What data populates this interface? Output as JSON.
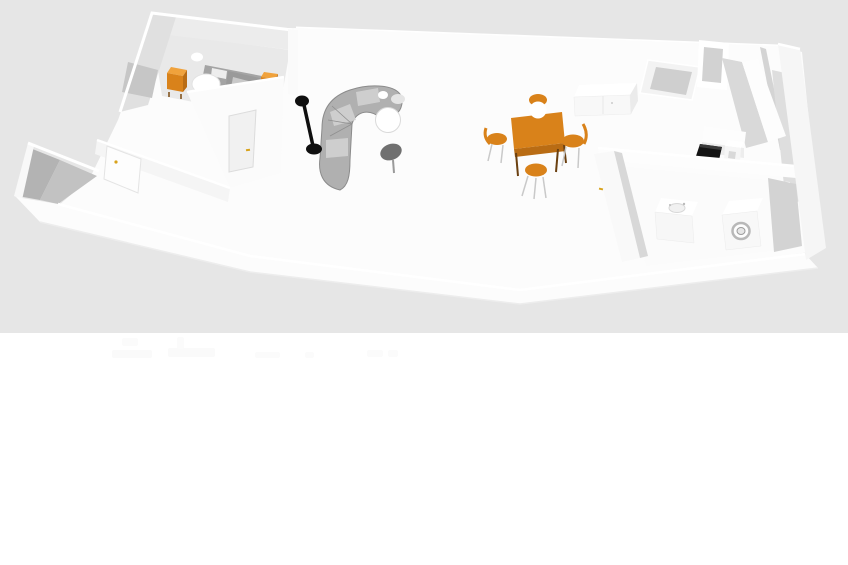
{
  "app": {
    "name": "floor-plan-3d-viewport",
    "description": "Aerial 3D rendering of a one-storey apartment floor plan shown in a design-software viewport. No text, menus or labels are visible - only the rendered model on a light grey viewport above a white page area."
  },
  "canvas": {
    "width": 848,
    "height": 565,
    "viewport_band_height": 333
  },
  "colors": {
    "viewport_bg": "#e6e6e6",
    "page_bg": "#ffffff",
    "wall_white": "#fbfbfb",
    "wall_light": "#f1f1f1",
    "wall_shade": "#d6d6d6",
    "wall_dark": "#b7b7b7",
    "floor": "#fcfcfc",
    "bath_floor": "#e9e9e9",
    "shower_dark": "#a4a4a4",
    "glass": "#ababab",
    "glass_light": "#c4c4c4",
    "orange": "#d9821a",
    "orange_dark": "#b96c14",
    "orange_light": "#f0a23c",
    "sofa_body": "#b0b0b0",
    "sofa_edge": "#8b8b8b",
    "sofa_cushion": "#d2d2d2",
    "lamp_black": "#0f0f0f",
    "cooktop_black": "#141414",
    "side_table_gray": "#707070",
    "handle_yellow": "#d8a21b",
    "ghost": "#fafafa"
  },
  "scene": {
    "rooms": [
      {
        "id": "entry-hall",
        "position": "far left",
        "contents": [
          "entry door with yellow handle"
        ]
      },
      {
        "id": "bathroom-1",
        "position": "top left",
        "contents": [
          "toilet",
          "two orange cabinets",
          "grey shower partition",
          "ceiling lamp",
          "door with yellow handle"
        ]
      },
      {
        "id": "living-room",
        "position": "centre left",
        "contents": [
          "black floor lamp",
          "curved grey sectional sofa",
          "round white ottoman",
          "dark kidney side table",
          "large two-pane window"
        ]
      },
      {
        "id": "dining-area",
        "position": "centre",
        "contents": [
          "orange dining table",
          "four orange chairs",
          "white pendant lamp",
          "lattice wall panel",
          "white sideboard"
        ]
      },
      {
        "id": "kitchen",
        "position": "top right",
        "contents": [
          "L-shaped white counter",
          "black cooktop",
          "open tilted door",
          "door frame"
        ]
      },
      {
        "id": "bathroom-2",
        "position": "bottom right",
        "contents": [
          "washbasin cabinet",
          "washing machine with round door",
          "door with yellow handle"
        ]
      }
    ],
    "object_count": 18
  }
}
